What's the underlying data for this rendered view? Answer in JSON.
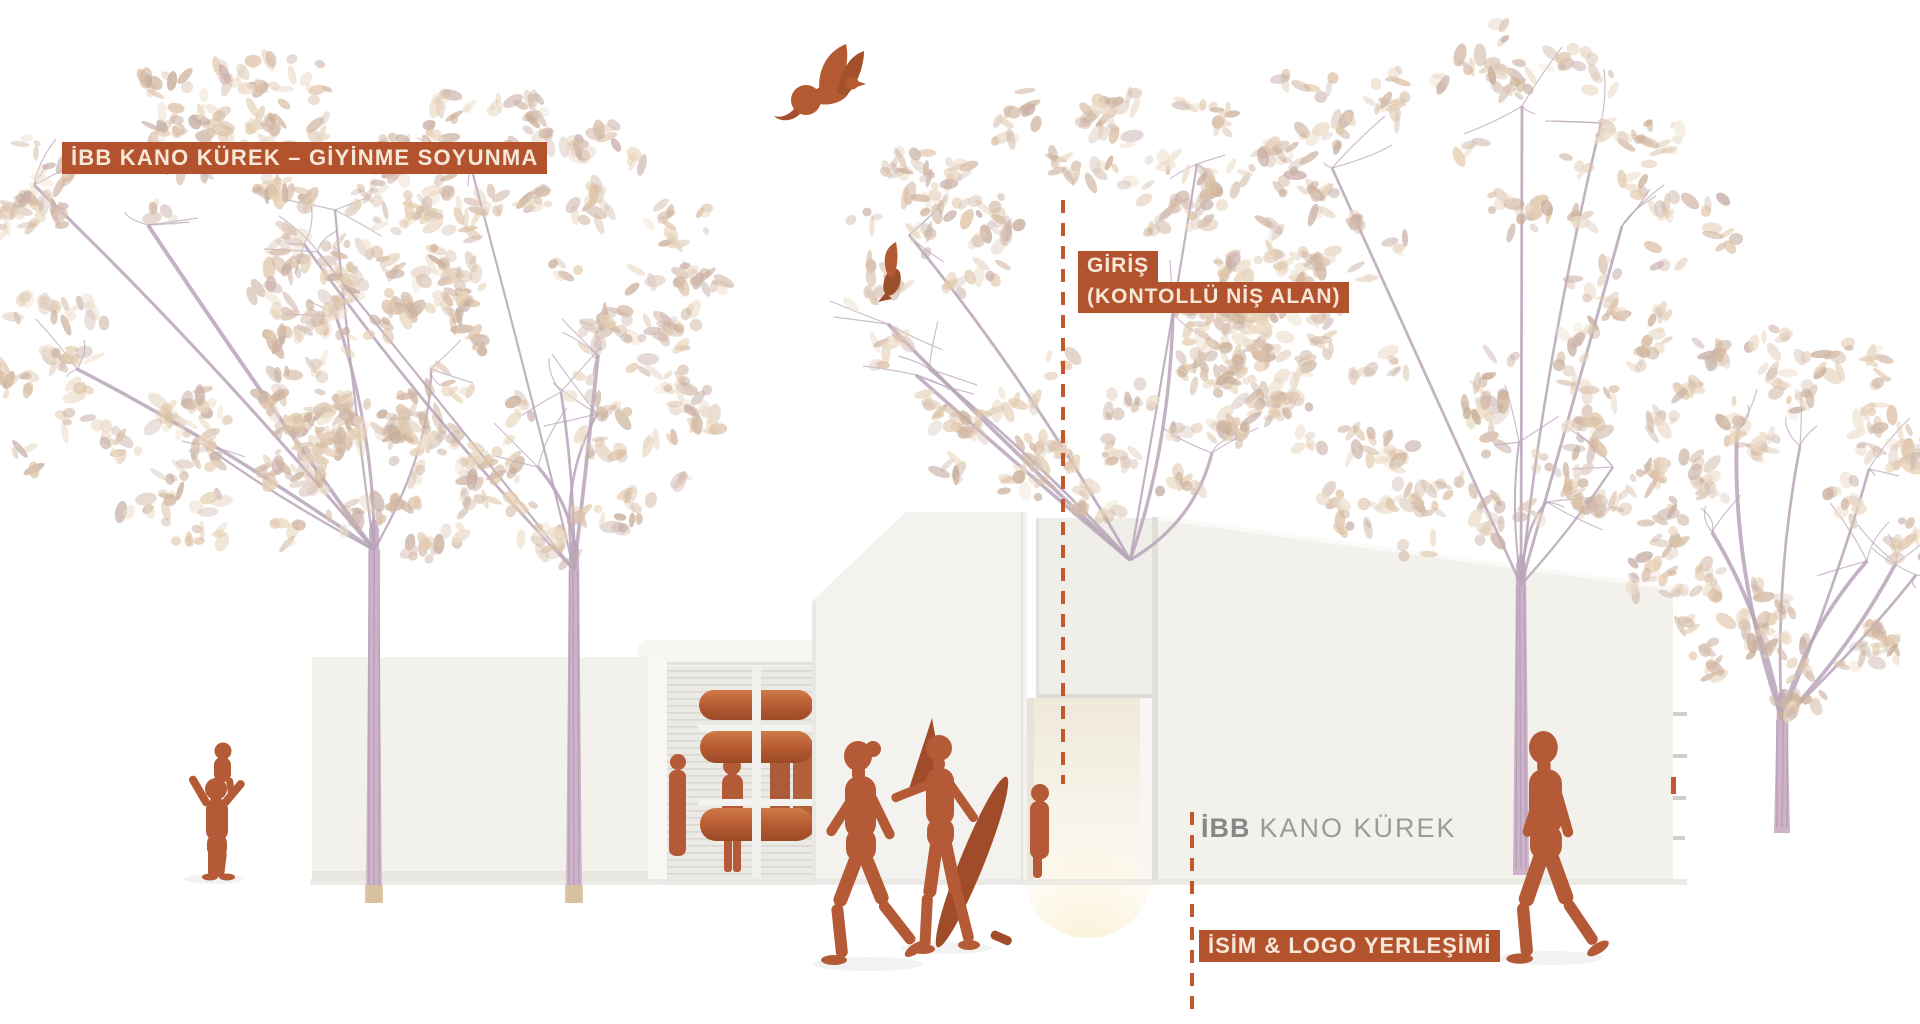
{
  "annotations": {
    "dressing_label": "İBB KANO KÜREK – GİYİNME SOYUNMA",
    "entrance_label_line1": "GİRİŞ",
    "entrance_label_line2": "(KONTOLLÜ NİŞ ALAN)",
    "logo_label": "İSİM & LOGO YERLEŞİMİ"
  },
  "building_sign": {
    "bold": "İBB",
    "rest": "KANO KÜREK"
  },
  "colors": {
    "annotation_bg": "#b2532e",
    "annotation_text": "#f6e7d8",
    "dashed_line": "#c2582c",
    "figure": "#b45a36",
    "figure_dark": "#a04c2a",
    "canoe": "#b85c33",
    "canoe_light": "#cf7a48",
    "building_face": "#f2f1ec",
    "building_side": "#f8f7f4",
    "foliage_light": "#e5cfb3",
    "foliage_dark": "#c9ae98",
    "branch": "#b7a4b8",
    "trunk": "#ccb3c9",
    "sign_bold_color": "#878787",
    "sign_rest_color": "#9b9b9b"
  }
}
